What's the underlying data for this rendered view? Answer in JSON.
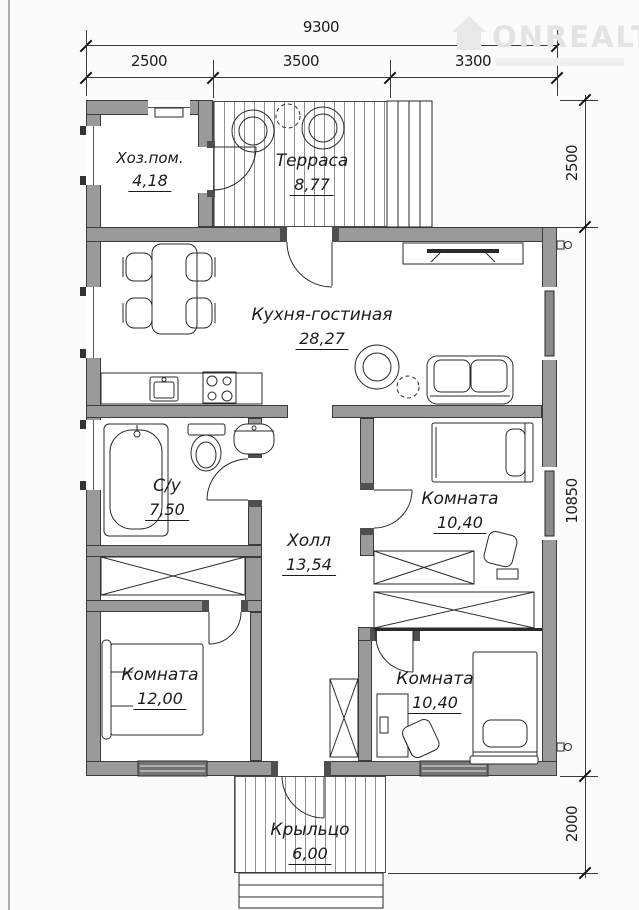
{
  "watermark": {
    "brand": "ONREALT",
    "icon": "house-icon"
  },
  "dimensions": {
    "top_total": "9300",
    "top_segments": [
      "2500",
      "3500",
      "3300"
    ],
    "right_segments": [
      "2500",
      "10850",
      "2000"
    ]
  },
  "rooms": {
    "utility": {
      "name": "Хоз.пом.",
      "area": "4,18"
    },
    "terrace": {
      "name": "Терраса",
      "area": "8,77"
    },
    "kitchen_living": {
      "name": "Кухня-гостиная",
      "area": "28,27"
    },
    "bathroom": {
      "name": "С/у",
      "area": "7,50"
    },
    "hall": {
      "name": "Холл",
      "area": "13,54"
    },
    "room_right_top": {
      "name": "Комната",
      "area": "10,40"
    },
    "room_left_bottom": {
      "name": "Комната",
      "area": "12,00"
    },
    "room_right_bottom": {
      "name": "Комната",
      "area": "10,40"
    },
    "porch": {
      "name": "Крыльцо",
      "area": "6,00"
    }
  },
  "colors": {
    "wall": "#9a9a9a",
    "line": "#2a2a2a",
    "watermark": "#e3e3e1",
    "floor": "#ffffff"
  }
}
